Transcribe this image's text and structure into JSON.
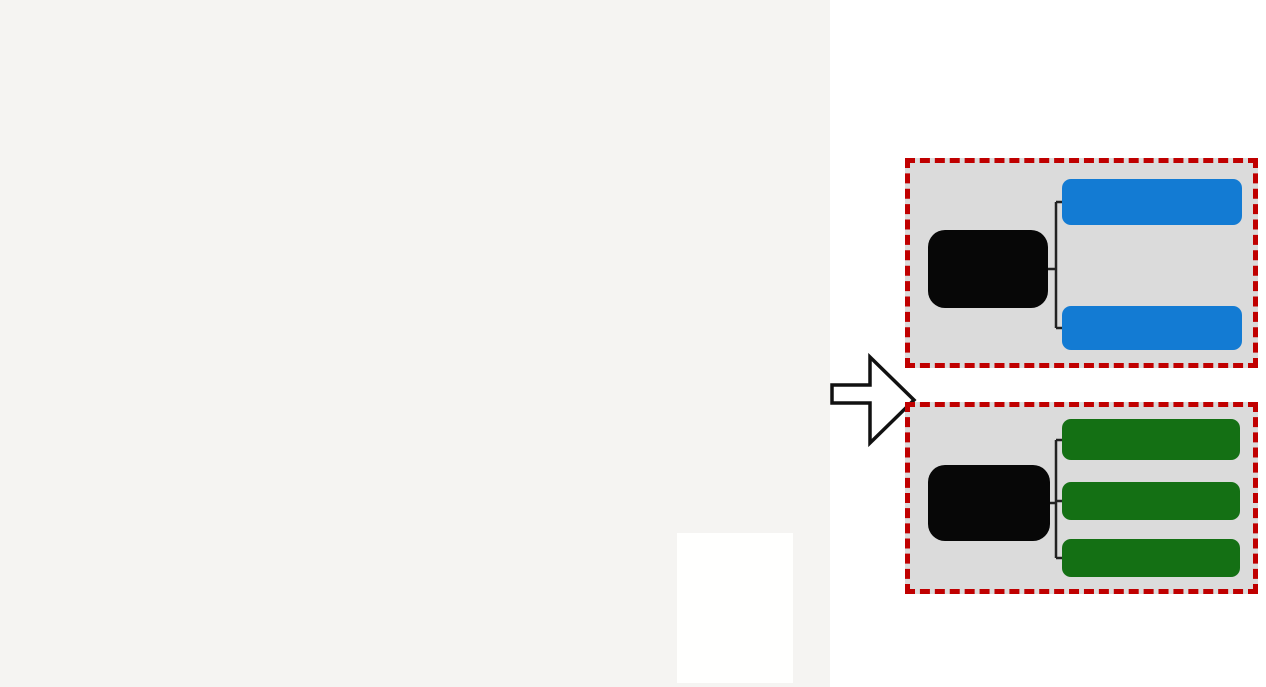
{
  "title": {
    "text": "现状建筑风貌类型",
    "color": "#c4691c"
  },
  "flow": {
    "groups": [
      {
        "parent": "传统空间",
        "parent_lines": [
          "传统",
          "空间"
        ],
        "child_color": "#137bd3",
        "children": [
          "传统街坊式",
          "传统鱼骨式"
        ]
      },
      {
        "parent": "现代空间",
        "parent_lines": [
          "现代",
          "空间"
        ],
        "child_color": "#147014",
        "children": [
          "现代聚落式",
          "排列式",
          "大体量单体建筑"
        ]
      }
    ]
  },
  "map": {
    "bg": "#f5f4f2",
    "colors": {
      "blue": "#2a5ca8",
      "green": "#5fa030",
      "orange": "#dfa32a",
      "red": "#d32222",
      "purple": "#9b4d9b",
      "water": "#cbdfee",
      "green_area": "#e6f2d7",
      "hill": "#d5e6c4",
      "contour": "#b9d2a2",
      "road": "#d8d6d2",
      "texture1": "#e4e3df",
      "texture2": "#d9d8d4",
      "boundary": "#b23a32",
      "inside_fill": "#fbfbf8",
      "white_block": "#fdfdfb",
      "white_block_stroke": "#d8d7d3"
    },
    "compass": {
      "x": 91,
      "y": 60,
      "r": 17,
      "label": "N"
    },
    "scalebar": {
      "x": 57,
      "y": 92,
      "labels": [
        "0",
        "50",
        "100",
        "150m"
      ]
    },
    "legend": {
      "title": "图 例",
      "items": [
        {
          "label": "文物保护单位",
          "color": "#d32222",
          "type": "solid"
        },
        {
          "label": "建议历史建筑",
          "color": "#9b4d9b",
          "type": "solid"
        },
        {
          "label": "传统风貌建筑",
          "color": "#dfa32a",
          "type": "solid"
        },
        {
          "label": "风貌协调的现代建筑",
          "color": "#5fa030",
          "type": "solid"
        },
        {
          "label": "风貌不协调的现代建筑",
          "color": "#2a5ca8",
          "type": "solid"
        },
        {
          "label": "绿地",
          "color": "#e6f2d7",
          "type": "solid"
        },
        {
          "label": "水系",
          "color": "#d9e8f5",
          "type": "solid"
        },
        {
          "label": "规划范围",
          "color": "#c0392b",
          "type": "dashed"
        }
      ]
    },
    "boundary_points": "218,36 300,50 400,62 480,68 524,58 562,47 622,32 650,27 688,60 720,93 743,133 752,163 739,183 751,211 768,267 778,318 786,362 788,392 781,424 770,458 757,491 743,517 700,560 640,601 560,636 460,657 300,664 150,664 89,663 88,562 85,467 83,384 82,354 107,338 118,311 131,281 144,254 154,228 161,198 174,168 184,131 199,78",
    "river_main": "M567,0 C576,90 586,190 591,265 C595,335 603,372 620,392 C590,400 480,404 360,407 L0,411 L0,481 L230,478 L430,472 C520,468 580,462 615,448 C638,438 650,418 655,395 C660,340 650,250 646,180 C643,120 642,60 643,0 Z",
    "stream": "0,62 70,52 140,30 225,8 300,0",
    "green_areas": [
      "M645,10 L672,8 L690,90 L695,180 L688,270 L672,350 L655,395 L645,330 L641,200 L641,80 Z",
      "M75,472 L250,469 L430,466 L545,461 L610,447 L650,408 L668,430 L720,400 L790,370 L830,355 L830,687 L75,687 Z",
      "M755,55 L830,30 L830,150 L790,140 L765,100 Z"
    ],
    "hills": [
      {
        "cx": 430,
        "cy": 645,
        "rx": 250,
        "ry": 110
      },
      {
        "cx": 755,
        "cy": 520,
        "rx": 130,
        "ry": 210
      },
      {
        "cx": 610,
        "cy": 620,
        "rx": 120,
        "ry": 90
      }
    ],
    "white_blocks": [
      {
        "x": 430,
        "y": 100,
        "w": 75,
        "h": 45,
        "rot": 12
      },
      {
        "x": 450,
        "y": 155,
        "w": 65,
        "h": 32,
        "rot": 8
      },
      {
        "x": 472,
        "y": 218,
        "w": 55,
        "h": 55,
        "rot": 0
      }
    ],
    "park": {
      "cx": 443,
      "cy": 250,
      "rx": 22,
      "ry": 15
    },
    "stadium": {
      "cx": 473,
      "cy": 292,
      "rx": 17,
      "ry": 11
    },
    "roads": [
      {
        "p": "0,418 92,356 162,266 200,170 216,42",
        "w": 6
      },
      {
        "p": "0,300 60,306 120,318",
        "w": 4
      },
      {
        "p": "700,145 770,165 830,158",
        "w": 4
      },
      {
        "p": "742,0 752,48 740,95",
        "w": 4
      },
      {
        "p": "60,687 100,610 88,560",
        "w": 4
      },
      {
        "p": "218,40 330,56 480,70 562,48 650,28",
        "w": 7
      },
      {
        "p": "198,80 258,160 330,252 396,332 442,392 470,428",
        "w": 7
      },
      {
        "p": "150,262 262,236 372,236 432,252 520,272 600,258",
        "w": 6
      },
      {
        "p": "432,252 446,180 452,100 456,42",
        "w": 6
      },
      {
        "p": "396,332 500,320 588,302",
        "w": 5
      },
      {
        "p": "470,428 548,432 612,408",
        "w": 5
      },
      {
        "p": "88,556 200,562 300,572 382,586 470,562 556,546 640,520 700,478",
        "w": 6
      },
      {
        "p": "652,30 680,90 700,145",
        "w": 5
      },
      {
        "p": "700,145 742,192 728,262 744,330 766,420 770,470",
        "w": 3
      }
    ],
    "clusters": [
      {
        "cx": 310,
        "cy": 130,
        "rx": 78,
        "ry": 72,
        "n": 50,
        "rot": -20,
        "minw": 7,
        "maxw": 14,
        "minh": 3,
        "maxh": 6,
        "pal": {
          "blue": 0.85,
          "green": 0.1,
          "orange": 0.05
        }
      },
      {
        "cx": 297,
        "cy": 110,
        "rx": 45,
        "ry": 28,
        "n": 13,
        "rot": -20,
        "minw": 10,
        "maxw": 18,
        "minh": 5,
        "maxh": 9,
        "pal": {
          "orange": 1
        }
      },
      {
        "cx": 440,
        "cy": 95,
        "rx": 50,
        "ry": 42,
        "n": 26,
        "rot": 15,
        "minw": 8,
        "maxw": 15,
        "minh": 3,
        "maxh": 5,
        "pal": {
          "blue": 0.92,
          "green": 0.08
        }
      },
      {
        "cx": 275,
        "cy": 240,
        "rx": 90,
        "ry": 85,
        "n": 65,
        "rot": 0,
        "minw": 5,
        "maxw": 10,
        "minh": 3,
        "maxh": 6,
        "pal": {
          "green": 0.78,
          "orange": 0.12,
          "blue": 0.1
        }
      },
      {
        "cx": 470,
        "cy": 190,
        "rx": 60,
        "ry": 70,
        "n": 48,
        "rot": 0,
        "minw": 5,
        "maxw": 10,
        "minh": 3,
        "maxh": 6,
        "pal": {
          "blue": 0.55,
          "green": 0.27,
          "orange": 0.18
        }
      },
      {
        "cx": 560,
        "cy": 170,
        "rx": 55,
        "ry": 80,
        "n": 52,
        "rot": 10,
        "minw": 4,
        "maxw": 9,
        "minh": 3,
        "maxh": 5,
        "pal": {
          "blue": 0.42,
          "green": 0.33,
          "orange": 0.25
        }
      },
      {
        "cx": 350,
        "cy": 345,
        "rx": 95,
        "ry": 65,
        "n": 75,
        "rot": -8,
        "minw": 4,
        "maxw": 9,
        "minh": 3,
        "maxh": 5,
        "pal": {
          "blue": 0.42,
          "orange": 0.28,
          "green": 0.22,
          "purple": 0.08
        }
      },
      {
        "cx": 500,
        "cy": 330,
        "rx": 65,
        "ry": 55,
        "n": 48,
        "rot": -5,
        "minw": 5,
        "maxw": 10,
        "minh": 3,
        "maxh": 5,
        "pal": {
          "blue": 0.55,
          "green": 0.2,
          "orange": 0.25
        }
      },
      {
        "cx": 430,
        "cy": 395,
        "rx": 105,
        "ry": 28,
        "n": 42,
        "rot": -5,
        "minw": 5,
        "maxw": 11,
        "minh": 3,
        "maxh": 5,
        "pal": {
          "blue": 0.5,
          "orange": 0.3,
          "green": 0.2
        }
      },
      {
        "cx": 165,
        "cy": 330,
        "rx": 75,
        "ry": 70,
        "n": 55,
        "rot": 12,
        "minw": 4,
        "maxw": 9,
        "minh": 3,
        "maxh": 5,
        "pal": {
          "green": 0.5,
          "orange": 0.32,
          "blue": 0.18
        }
      },
      {
        "cx": 585,
        "cy": 265,
        "rx": 38,
        "ry": 60,
        "n": 26,
        "rot": 0,
        "minw": 4,
        "maxw": 8,
        "minh": 3,
        "maxh": 5,
        "pal": {
          "green": 0.4,
          "orange": 0.35,
          "blue": 0.25
        }
      },
      {
        "cx": 700,
        "cy": 135,
        "rx": 58,
        "ry": 95,
        "n": 60,
        "rot": -35,
        "minw": 6,
        "maxw": 12,
        "minh": 2,
        "maxh": 4,
        "pal": {
          "green": 0.88,
          "orange": 0.08,
          "blue": 0.04
        }
      },
      {
        "cx": 660,
        "cy": 180,
        "rx": 25,
        "ry": 65,
        "n": 16,
        "rot": -30,
        "minw": 6,
        "maxw": 11,
        "minh": 3,
        "maxh": 6,
        "pal": {
          "orange": 0.82,
          "green": 0.18
        }
      },
      {
        "cx": 745,
        "cy": 290,
        "rx": 28,
        "ry": 62,
        "n": 18,
        "rot": 10,
        "minw": 5,
        "maxw": 10,
        "minh": 3,
        "maxh": 5,
        "pal": {
          "orange": 0.7,
          "green": 0.3
        }
      },
      {
        "cx": 768,
        "cy": 385,
        "rx": 22,
        "ry": 40,
        "n": 10,
        "rot": 0,
        "minw": 5,
        "maxw": 9,
        "minh": 3,
        "maxh": 5,
        "pal": {
          "orange": 0.8,
          "green": 0.2
        }
      },
      {
        "cx": 790,
        "cy": 105,
        "rx": 35,
        "ry": 48,
        "n": 16,
        "rot": -15,
        "minw": 5,
        "maxw": 9,
        "minh": 3,
        "maxh": 5,
        "pal": {
          "orange": 0.55,
          "green": 0.45
        }
      },
      {
        "cx": 140,
        "cy": 515,
        "rx": 48,
        "ry": 48,
        "n": 30,
        "rot": 0,
        "minw": 4,
        "maxw": 8,
        "minh": 3,
        "maxh": 5,
        "pal": {
          "orange": 0.42,
          "green": 0.44,
          "blue": 0.14
        }
      },
      {
        "cx": 265,
        "cy": 522,
        "rx": 62,
        "ry": 45,
        "n": 34,
        "rot": 5,
        "minw": 4,
        "maxw": 9,
        "minh": 3,
        "maxh": 5,
        "pal": {
          "green": 0.68,
          "blue": 0.16,
          "orange": 0.16
        }
      },
      {
        "cx": 380,
        "cy": 540,
        "rx": 50,
        "ry": 35,
        "n": 24,
        "rot": -5,
        "minw": 4,
        "maxw": 9,
        "minh": 3,
        "maxh": 5,
        "pal": {
          "blue": 0.4,
          "green": 0.3,
          "orange": 0.3
        }
      },
      {
        "cx": 120,
        "cy": 605,
        "rx": 30,
        "ry": 42,
        "n": 20,
        "rot": 20,
        "minw": 5,
        "maxw": 10,
        "minh": 3,
        "maxh": 5,
        "pal": {
          "blue": 0.78,
          "green": 0.22
        }
      },
      {
        "cx": 170,
        "cy": 620,
        "rx": 27,
        "ry": 40,
        "n": 15,
        "rot": 10,
        "minw": 4,
        "maxw": 8,
        "minh": 3,
        "maxh": 5,
        "pal": {
          "orange": 0.5,
          "green": 0.5
        }
      },
      {
        "cx": 400,
        "cy": 625,
        "rx": 60,
        "ry": 38,
        "n": 28,
        "rot": -10,
        "minw": 4,
        "maxw": 9,
        "minh": 3,
        "maxh": 5,
        "pal": {
          "orange": 0.45,
          "blue": 0.3,
          "green": 0.25
        }
      },
      {
        "cx": 520,
        "cy": 555,
        "rx": 55,
        "ry": 35,
        "n": 18,
        "rot": -15,
        "minw": 6,
        "maxw": 12,
        "minh": 3,
        "maxh": 6,
        "pal": {
          "blue": 0.45,
          "green": 0.3,
          "orange": 0.25
        }
      },
      {
        "cx": 590,
        "cy": 520,
        "rx": 48,
        "ry": 55,
        "n": 16,
        "rot": -28,
        "minw": 12,
        "maxw": 20,
        "minh": 3,
        "maxh": 6,
        "pal": {
          "blue": 0.95,
          "green": 0.05
        }
      },
      {
        "cx": 600,
        "cy": 610,
        "rx": 45,
        "ry": 40,
        "n": 16,
        "rot": -20,
        "minw": 8,
        "maxw": 16,
        "minh": 3,
        "maxh": 5,
        "pal": {
          "blue": 0.75,
          "green": 0.25
        }
      },
      {
        "cx": 530,
        "cy": 650,
        "rx": 32,
        "ry": 22,
        "n": 8,
        "rot": 0,
        "minw": 10,
        "maxw": 16,
        "minh": 3,
        "maxh": 5,
        "pal": {
          "green": 0.95,
          "blue": 0.05
        }
      },
      {
        "cx": 645,
        "cy": 515,
        "rx": 28,
        "ry": 40,
        "n": 12,
        "rot": -25,
        "minw": 8,
        "maxw": 16,
        "minh": 3,
        "maxh": 5,
        "pal": {
          "blue": 0.9,
          "green": 0.1
        }
      }
    ],
    "landmarks": {
      "red": [
        {
          "x": 436,
          "y": 136,
          "w": 9,
          "h": 16,
          "rot": 0
        },
        {
          "x": 533,
          "y": 246,
          "w": 10,
          "h": 20,
          "rot": -28
        },
        {
          "x": 414,
          "y": 366,
          "w": 10,
          "h": 22,
          "rot": -15
        },
        {
          "x": 385,
          "y": 382,
          "w": 8,
          "h": 11,
          "rot": 0
        },
        {
          "x": 364,
          "y": 348,
          "w": 7,
          "h": 9,
          "rot": 0
        }
      ],
      "purple": [
        {
          "x": 340,
          "y": 328,
          "w": 8,
          "h": 8,
          "rot": 0
        },
        {
          "x": 350,
          "y": 358,
          "w": 7,
          "h": 9,
          "rot": 0
        },
        {
          "x": 332,
          "y": 388,
          "w": 7,
          "h": 7,
          "rot": 0
        },
        {
          "x": 522,
          "y": 437,
          "w": 7,
          "h": 7,
          "rot": 0
        },
        {
          "x": 368,
          "y": 300,
          "w": 6,
          "h": 8,
          "rot": 0
        }
      ],
      "h_building": {
        "x": 282,
        "y": 186,
        "w": 30,
        "h": 18
      }
    }
  }
}
